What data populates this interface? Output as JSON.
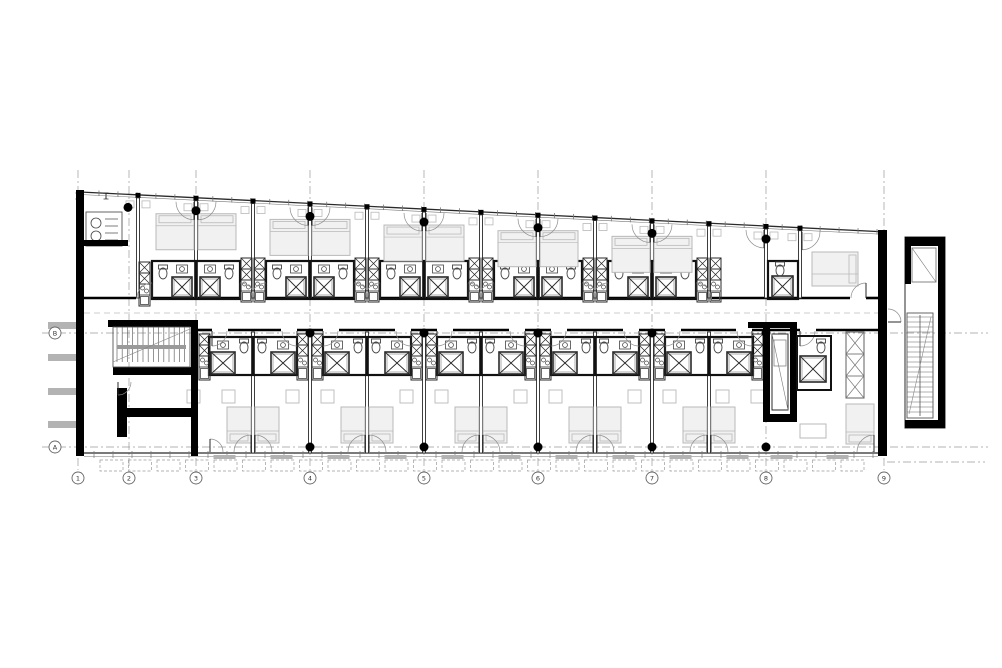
{
  "meta": {
    "drawing_type": "architectural floor plan"
  },
  "plan": {
    "canvas": {
      "w": 1002,
      "h": 668,
      "background": "#ffffff"
    },
    "palette": {
      "wall": "#000000",
      "line": "#2a2a2a",
      "thin": "#555555",
      "mid": "#777777",
      "furniture": "#b9b9b9",
      "furniture_fill": "#f1f1f1",
      "fixture": "#444444",
      "dash": "#9a9a9a",
      "fin": "#b3b3b3",
      "sill": "#b3b3b3",
      "bubble": "#666666",
      "label": "#333333"
    },
    "grid": {
      "columns": [
        {
          "label": "1",
          "x": 78
        },
        {
          "label": "2",
          "x": 129
        },
        {
          "label": "3",
          "x": 196
        },
        {
          "label": "4",
          "x": 310
        },
        {
          "label": "5",
          "x": 424
        },
        {
          "label": "6",
          "x": 538
        },
        {
          "label": "7",
          "x": 652
        },
        {
          "label": "8",
          "x": 766
        },
        {
          "label": "9",
          "x": 884
        }
      ],
      "rows": [
        {
          "label": "A",
          "y": 447
        },
        {
          "label": "B",
          "y": 333
        }
      ],
      "column_bubble_y": 478,
      "row_bubble_x": 55,
      "bubble_r": 6,
      "v_top": 170,
      "v_bottom": 470,
      "h_x0": 42,
      "h_x1": 988,
      "extra_dash": {
        "y": 462,
        "x0": 887,
        "x1": 985
      }
    },
    "facade": {
      "x0": 80,
      "y0": 192,
      "x1": 887,
      "y1": 232,
      "tick_step": 19
    },
    "walls": {
      "left": {
        "x": 76,
        "w": 8,
        "y0": 190,
        "y1": 456
      },
      "right": {
        "x": 878,
        "w": 9,
        "y0": 230,
        "y1": 456
      },
      "bottom_y": 453,
      "bottom_x0": 84,
      "bottom_x1": 878,
      "corridor_top": 298,
      "corridor_bottom": 330,
      "corridor_dash_y": 313
    },
    "partitions": {
      "upper": [
        138,
        196,
        253,
        310,
        367,
        424,
        481,
        538,
        595,
        652,
        709,
        766,
        800
      ],
      "lower": [
        253,
        310,
        367,
        424,
        481,
        538,
        595,
        652,
        709
      ],
      "lower_ext": [
        196,
        253,
        310,
        367,
        424,
        481,
        538,
        595,
        652,
        709,
        766,
        797,
        878
      ]
    },
    "pods": {
      "w": 88,
      "h": 38,
      "upper_centers": [
        196,
        310,
        424,
        538,
        652
      ],
      "upper_y": 261,
      "lower_centers": [
        253,
        367,
        481,
        595,
        709
      ],
      "lower_y": 337
    },
    "kitchens": {
      "col_w": 11,
      "upper_centers": [
        253,
        367,
        481,
        595,
        709
      ],
      "upper_y": 258,
      "upper_h": 44,
      "lower_centers": [
        310,
        424,
        538,
        652
      ],
      "lower_y": 334,
      "lower_h": 46,
      "upper_singles": [
        139
      ],
      "lower_singles": [
        199,
        752
      ]
    },
    "doors": {
      "radius": 15,
      "facade_radius": 18,
      "balcony_radius": 17
    },
    "dots": {
      "r": 4.5,
      "top_xs": [
        128,
        196,
        310,
        424,
        538,
        652,
        766
      ],
      "top_dy": 13,
      "mid_xs": [
        310,
        424,
        538,
        652,
        766
      ],
      "mid_y": 333,
      "bottom_xs": [
        310,
        424,
        538,
        652,
        766
      ],
      "bottom_y": 447
    },
    "beds": {
      "upper_w": 38,
      "upper_h": 36,
      "upper_dy": 16,
      "lower_w": 24,
      "lower_h": 36,
      "lower_y": 407
    },
    "tables": {
      "lower_y": 390,
      "size": 13
    },
    "left_core": {
      "stair": {
        "x": 113,
        "y": 327,
        "w": 77,
        "h": 40,
        "step": 5.2
      },
      "walls": [
        [
          108,
          320,
          89,
          7
        ],
        [
          191,
          320,
          7,
          136
        ],
        [
          113,
          367,
          84,
          8
        ],
        [
          117,
          388,
          10,
          49
        ],
        [
          127,
          408,
          70,
          9
        ]
      ]
    },
    "right_core": {
      "walls": [
        [
          748,
          322,
          49,
          6
        ],
        [
          763,
          322,
          7,
          100
        ],
        [
          790,
          322,
          7,
          100
        ],
        [
          763,
          414,
          34,
          8
        ]
      ],
      "lift": {
        "x": 772,
        "y": 334,
        "w": 16,
        "h": 76
      }
    },
    "annex": {
      "x": 905,
      "y": 237,
      "w": 40,
      "h": 191,
      "blacks": [
        [
          905,
          237,
          40,
          9
        ],
        [
          938,
          237,
          7,
          191
        ],
        [
          905,
          420,
          40,
          8
        ],
        [
          905,
          237,
          6,
          47
        ]
      ],
      "lift": {
        "x": 912,
        "y": 248,
        "w": 24,
        "h": 34
      },
      "stair": {
        "x": 907,
        "y": 313,
        "w": 26,
        "h": 105,
        "step": 5
      }
    },
    "machine": {
      "box": [
        86,
        212,
        36,
        34
      ],
      "bar": [
        78,
        240,
        50,
        6
      ]
    },
    "fins": {
      "x": 48,
      "w": 29,
      "ys": [
        322,
        354,
        388,
        421
      ],
      "h": 7
    },
    "corner_upper": {
      "pod": [
        768,
        261,
        30,
        38
      ],
      "bed": [
        812,
        252,
        46,
        34
      ]
    },
    "corner_lower": {
      "pod": [
        797,
        336,
        34,
        54
      ],
      "shower": [
        800,
        356,
        26,
        26
      ],
      "wardrobe": [
        846,
        332,
        18,
        66
      ],
      "bed": [
        846,
        404,
        28,
        40
      ],
      "sofa": [
        800,
        424,
        26,
        14
      ]
    },
    "balcony_panels": {
      "y": 460,
      "h": 11,
      "x0": 100,
      "x1": 856,
      "step": 28.5,
      "w": 23
    },
    "section_ticks": [
      [
        78,
        196
      ],
      [
        106,
        196
      ]
    ]
  }
}
